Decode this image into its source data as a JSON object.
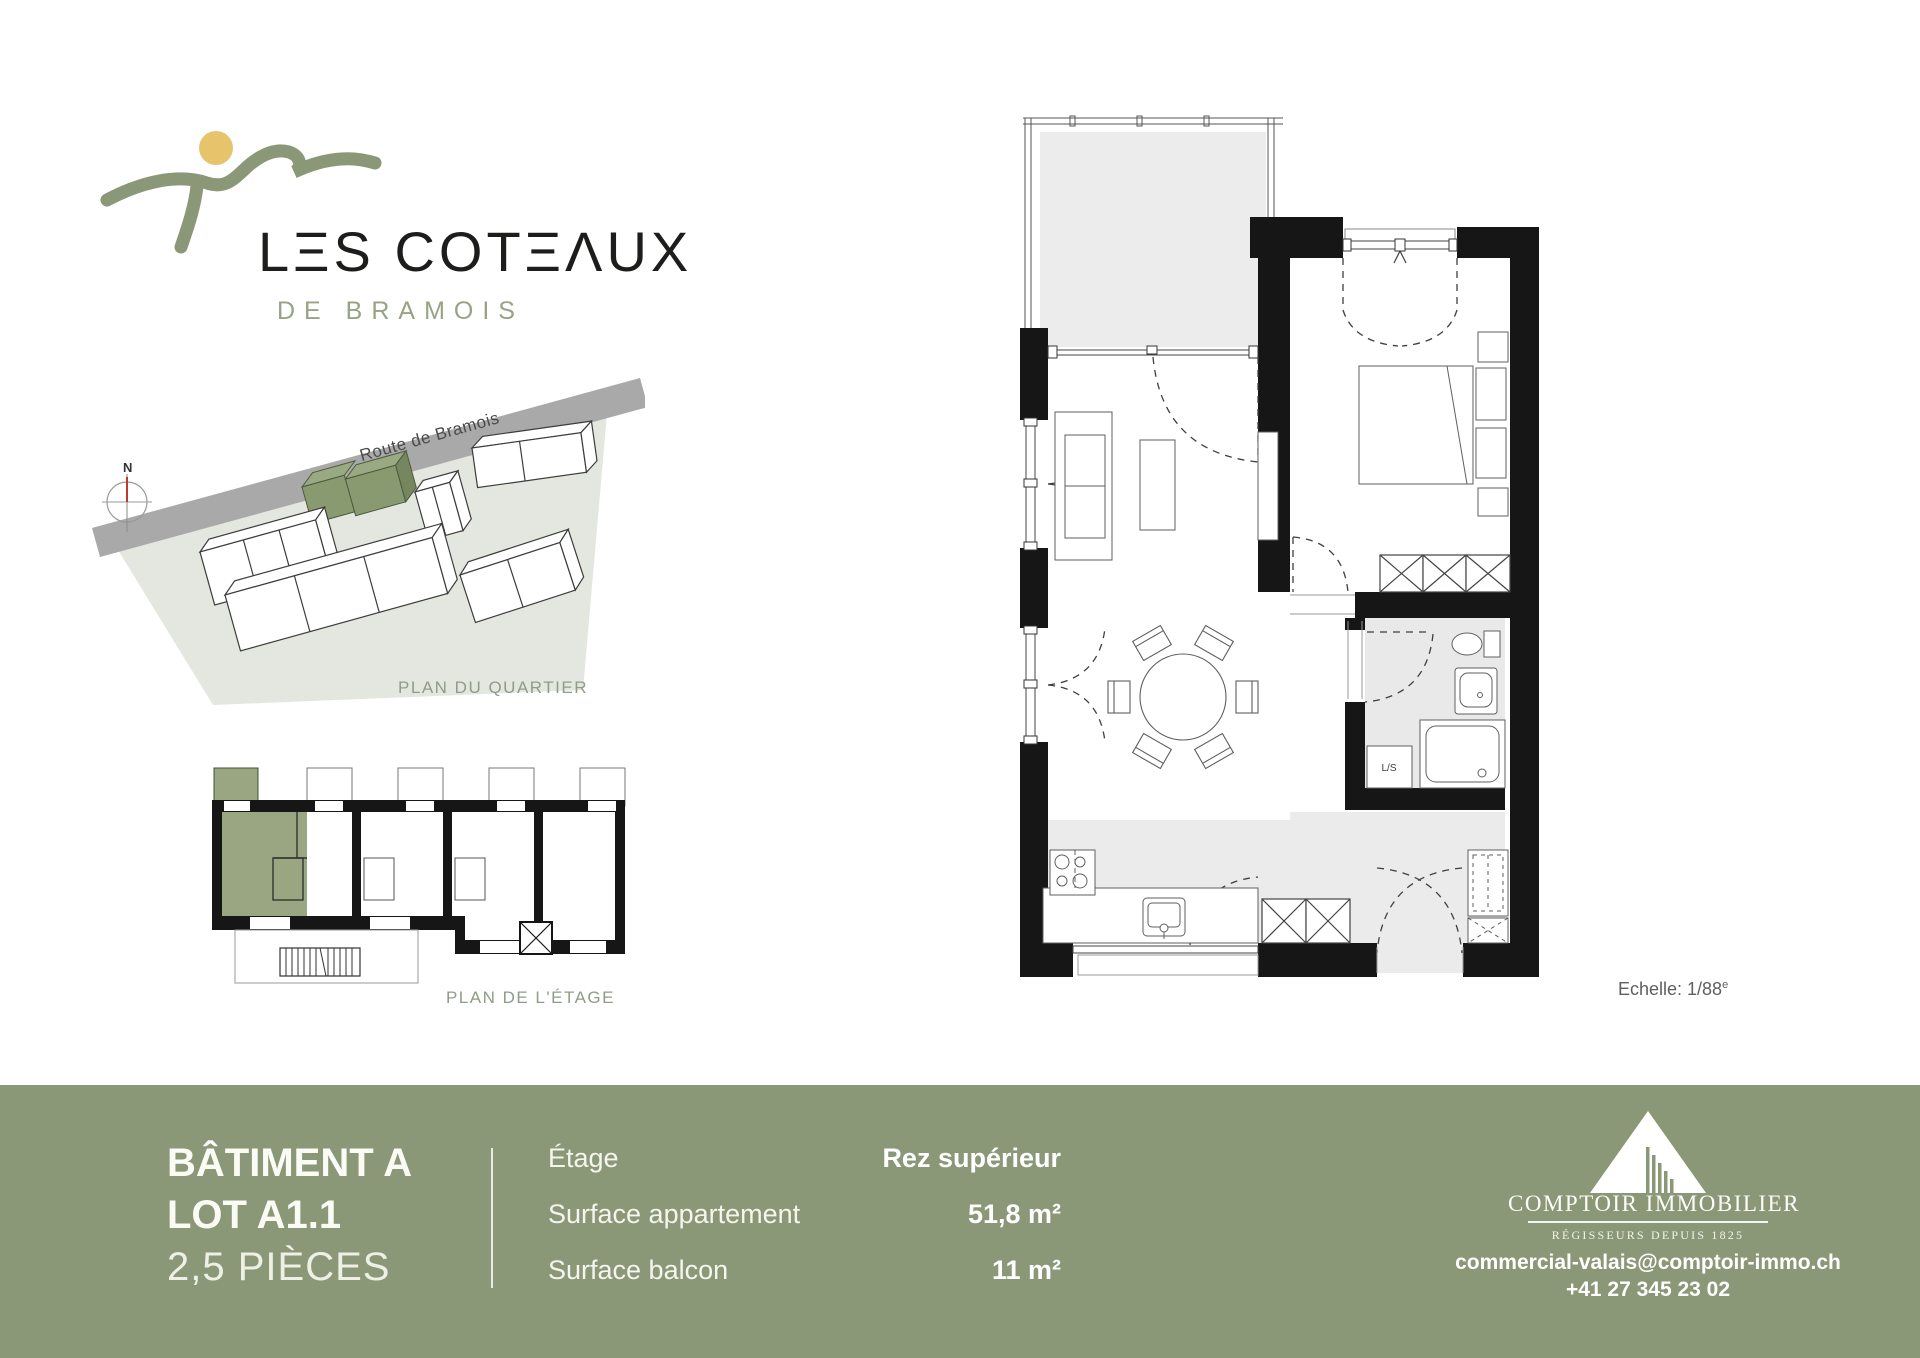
{
  "brand": {
    "wordmark": "LΞS COTΞΛUX",
    "subtitle": "DE BRAMOIS",
    "sun_color": "#e5c46c",
    "swoosh_color": "#8a9877",
    "text_color": "#1d1d1b"
  },
  "quartier": {
    "caption": "PLAN DU QUARTIER",
    "road_label": "Route de Bramois",
    "compass": "N",
    "site_color": "#e4e7df",
    "road_color": "#a9a9a9",
    "highlight_color": "#8a9a70"
  },
  "etage": {
    "caption": "PLAN DE L'ÉTAGE",
    "highlight_color": "#9aa682"
  },
  "plan": {
    "scale_text": "Echelle: 1/88",
    "scale_sup": "e",
    "ls_label": "L/S",
    "wall_color": "#161616",
    "floor_gray": "#ebebeb"
  },
  "footer": {
    "band_color": "#8a9877",
    "building": "BÂTIMENT A",
    "lot": "LOT A1.1",
    "rooms": "2,5 PIÈCES",
    "rows": [
      {
        "label": "Étage",
        "value": "Rez supérieur"
      },
      {
        "label": "Surface appartement",
        "value": "51,8 m²"
      },
      {
        "label": "Surface balcon",
        "value": "11 m²"
      }
    ],
    "agency": {
      "name": "COMPTOIR IMMOBILIER",
      "tagline": "RÉGISSEURS DEPUIS 1825",
      "email": "commercial-valais@comptoir-immo.ch",
      "phone": "+41 27 345 23 02"
    }
  }
}
